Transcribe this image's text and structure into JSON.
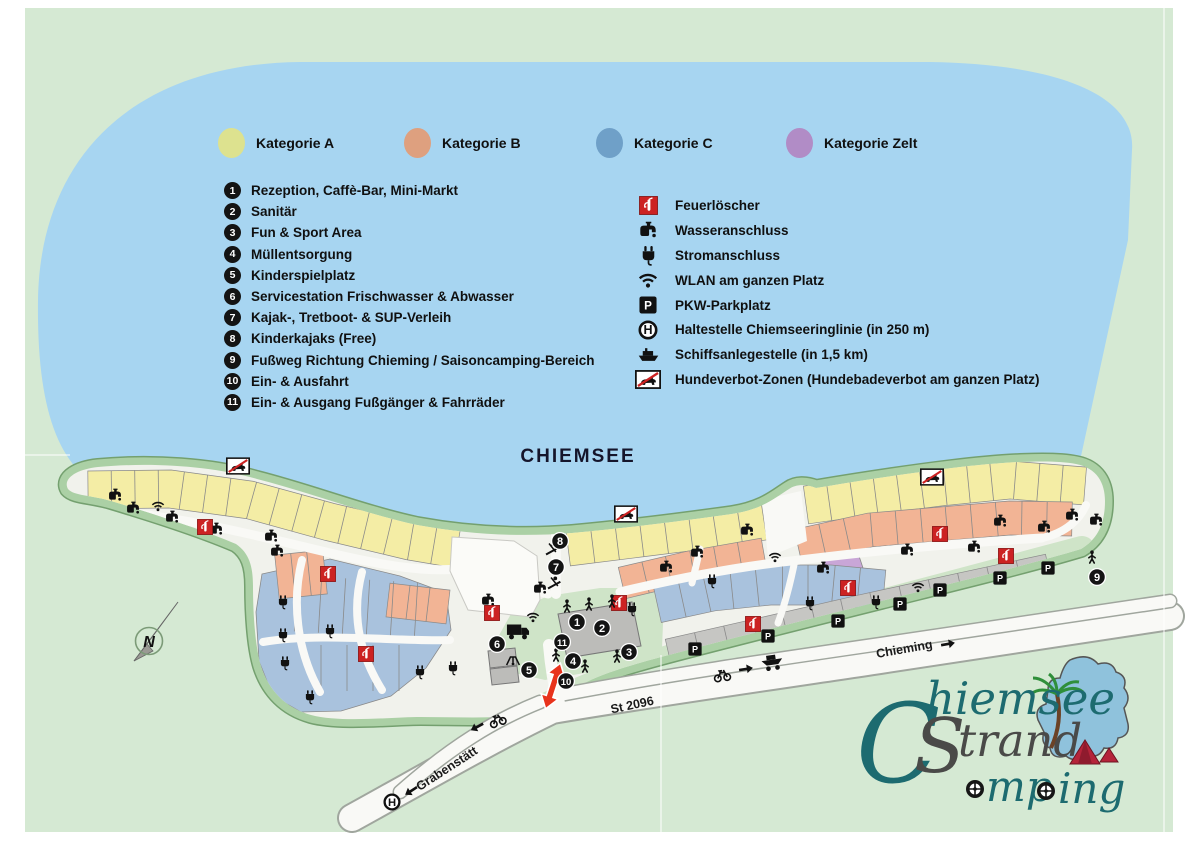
{
  "colors": {
    "background": "#d5e9d3",
    "lake": "#a7d5f1",
    "land_border": "#abd0a5",
    "land_rim": "#74a06f",
    "land_base": "#f1f2ec",
    "lawn": "#cfe4c8",
    "road": "#f9f9f6",
    "road_casing": "#a0a69e",
    "parking": "#c6c6c3",
    "building": "#bcbcb9",
    "kategorie_a": "#dde28f",
    "kategorie_b": "#dea07f",
    "kategorie_c": "#6fa0c8",
    "kategorie_zelt": "#b18cc6",
    "pitch_a": "#f4eda5",
    "pitch_b": "#f2b495",
    "pitch_c": "#a9c2dd",
    "pitch_zelt": "#c9a6d7",
    "fire_red": "#cc2222",
    "arrow_red": "#e8331c"
  },
  "legend": {
    "categories": [
      {
        "label": "Kategorie A",
        "color": "#dde28f"
      },
      {
        "label": "Kategorie B",
        "color": "#dea07f"
      },
      {
        "label": "Kategorie C",
        "color": "#6fa0c8"
      },
      {
        "label": "Kategorie Zelt",
        "color": "#b18cc6"
      }
    ],
    "items": [
      {
        "number": "1",
        "label": "Rezeption, Caffè-Bar, Mini-Markt"
      },
      {
        "number": "2",
        "label": "Sanitär"
      },
      {
        "number": "3",
        "label": "Fun & Sport Area"
      },
      {
        "number": "4",
        "label": "Müllentsorgung"
      },
      {
        "number": "5",
        "label": "Kinderspielplatz"
      },
      {
        "number": "6",
        "label": "Servicestation Frischwasser & Abwasser"
      },
      {
        "number": "7",
        "label": "Kajak-, Tretboot- & SUP-Verleih"
      },
      {
        "number": "8",
        "label": "Kinderkajaks (Free)"
      },
      {
        "number": "9",
        "label": "Fußweg Richtung Chieming / Saisoncamping-Bereich"
      },
      {
        "number": "10",
        "label": "Ein- & Ausfahrt"
      },
      {
        "number": "11",
        "label": "Ein- & Ausgang Fußgänger & Fahrräder"
      }
    ],
    "icon_items": [
      {
        "icon": "fireext",
        "label": "Feuerlöscher"
      },
      {
        "icon": "faucet",
        "label": "Wasseranschluss"
      },
      {
        "icon": "plug",
        "label": "Stromanschluss"
      },
      {
        "icon": "wifi",
        "label": "WLAN am ganzen Platz"
      },
      {
        "icon": "parking",
        "label": "PKW-Parkplatz"
      },
      {
        "icon": "bus-stop",
        "label": "Haltestelle Chiemseeringlinie (in 250 m)"
      },
      {
        "icon": "ship",
        "label": "Schiffsanlegestelle (in 1,5 km)"
      },
      {
        "icon": "no-dog",
        "label": "Hundeverbot-Zonen (Hundebadeverbot am ganzen Platz)"
      }
    ]
  },
  "map": {
    "lake_label": "CHIEMSEE",
    "compass": "N",
    "glyphs": {
      "p": "P",
      "h": "H"
    },
    "roads": {
      "st2096": "St 2096",
      "grabenstaett": "Grabenstätt",
      "chieming": "Chieming"
    },
    "markers": [
      {
        "n": "1",
        "x": 577,
        "y": 622
      },
      {
        "n": "2",
        "x": 602,
        "y": 628
      },
      {
        "n": "3",
        "x": 629,
        "y": 652
      },
      {
        "n": "4",
        "x": 573,
        "y": 661
      },
      {
        "n": "5",
        "x": 529,
        "y": 670
      },
      {
        "n": "6",
        "x": 497,
        "y": 644
      },
      {
        "n": "7",
        "x": 556,
        "y": 567
      },
      {
        "n": "8",
        "x": 560,
        "y": 541
      },
      {
        "n": "9",
        "x": 1097,
        "y": 577
      },
      {
        "n": "10",
        "x": 566,
        "y": 681
      },
      {
        "n": "11",
        "x": 562,
        "y": 642
      }
    ],
    "icons": [
      {
        "t": "faucet",
        "x": 115,
        "y": 495
      },
      {
        "t": "faucet",
        "x": 133,
        "y": 508
      },
      {
        "t": "faucet",
        "x": 172,
        "y": 517
      },
      {
        "t": "faucet",
        "x": 216,
        "y": 529
      },
      {
        "t": "faucet",
        "x": 271,
        "y": 536
      },
      {
        "t": "faucet",
        "x": 277,
        "y": 551
      },
      {
        "t": "faucet",
        "x": 488,
        "y": 600
      },
      {
        "t": "faucet",
        "x": 540,
        "y": 588
      },
      {
        "t": "faucet",
        "x": 666,
        "y": 567
      },
      {
        "t": "faucet",
        "x": 697,
        "y": 552
      },
      {
        "t": "faucet",
        "x": 747,
        "y": 530
      },
      {
        "t": "faucet",
        "x": 823,
        "y": 568
      },
      {
        "t": "faucet",
        "x": 907,
        "y": 550
      },
      {
        "t": "faucet",
        "x": 974,
        "y": 547
      },
      {
        "t": "faucet",
        "x": 1000,
        "y": 521
      },
      {
        "t": "faucet",
        "x": 1044,
        "y": 527
      },
      {
        "t": "faucet",
        "x": 1072,
        "y": 515
      },
      {
        "t": "faucet",
        "x": 1096,
        "y": 520
      },
      {
        "t": "plug",
        "x": 283,
        "y": 602
      },
      {
        "t": "plug",
        "x": 283,
        "y": 635
      },
      {
        "t": "plug",
        "x": 285,
        "y": 663
      },
      {
        "t": "plug",
        "x": 310,
        "y": 697
      },
      {
        "t": "plug",
        "x": 330,
        "y": 631
      },
      {
        "t": "plug",
        "x": 420,
        "y": 672
      },
      {
        "t": "plug",
        "x": 453,
        "y": 668
      },
      {
        "t": "plug",
        "x": 632,
        "y": 609
      },
      {
        "t": "plug",
        "x": 712,
        "y": 581
      },
      {
        "t": "plug",
        "x": 810,
        "y": 603
      },
      {
        "t": "plug",
        "x": 876,
        "y": 602
      },
      {
        "t": "wifi",
        "x": 158,
        "y": 506
      },
      {
        "t": "wifi",
        "x": 533,
        "y": 617
      },
      {
        "t": "wifi",
        "x": 775,
        "y": 557
      },
      {
        "t": "wifi",
        "x": 918,
        "y": 587
      },
      {
        "t": "fireext",
        "x": 205,
        "y": 527
      },
      {
        "t": "fireext",
        "x": 328,
        "y": 574
      },
      {
        "t": "fireext",
        "x": 366,
        "y": 654
      },
      {
        "t": "fireext",
        "x": 492,
        "y": 613
      },
      {
        "t": "fireext",
        "x": 619,
        "y": 603
      },
      {
        "t": "fireext",
        "x": 753,
        "y": 624
      },
      {
        "t": "fireext",
        "x": 848,
        "y": 588
      },
      {
        "t": "fireext",
        "x": 940,
        "y": 534
      },
      {
        "t": "fireext",
        "x": 1006,
        "y": 556
      },
      {
        "t": "parking",
        "x": 695,
        "y": 649
      },
      {
        "t": "parking",
        "x": 768,
        "y": 636
      },
      {
        "t": "parking",
        "x": 838,
        "y": 621
      },
      {
        "t": "parking",
        "x": 900,
        "y": 604
      },
      {
        "t": "parking",
        "x": 940,
        "y": 590
      },
      {
        "t": "parking",
        "x": 1000,
        "y": 578
      },
      {
        "t": "parking",
        "x": 1048,
        "y": 568
      },
      {
        "t": "no-dog",
        "x": 238,
        "y": 466
      },
      {
        "t": "no-dog",
        "x": 626,
        "y": 514
      },
      {
        "t": "no-dog",
        "x": 932,
        "y": 477
      },
      {
        "t": "bus-stop",
        "x": 392,
        "y": 802
      },
      {
        "t": "bike",
        "x": 497,
        "y": 719,
        "r": -20
      },
      {
        "t": "bike",
        "x": 722,
        "y": 674,
        "r": -8
      },
      {
        "t": "arrow-l",
        "x": 477,
        "y": 727,
        "r": -28
      },
      {
        "t": "arrow-r",
        "x": 746,
        "y": 669,
        "r": -9
      },
      {
        "t": "arrow-l",
        "x": 411,
        "y": 791,
        "r": -33
      },
      {
        "t": "arrow-r",
        "x": 948,
        "y": 644,
        "r": -10
      },
      {
        "t": "boat",
        "x": 772,
        "y": 661,
        "r": -8
      },
      {
        "t": "truck",
        "x": 518,
        "y": 631
      },
      {
        "t": "person",
        "x": 567,
        "y": 606
      },
      {
        "t": "person",
        "x": 589,
        "y": 604
      },
      {
        "t": "person",
        "x": 612,
        "y": 601
      },
      {
        "t": "person",
        "x": 556,
        "y": 655
      },
      {
        "t": "person",
        "x": 585,
        "y": 666
      },
      {
        "t": "person",
        "x": 617,
        "y": 656
      },
      {
        "t": "person",
        "x": 1092,
        "y": 557
      },
      {
        "t": "kayak",
        "x": 552,
        "y": 549
      },
      {
        "t": "kayak",
        "x": 554,
        "y": 583
      },
      {
        "t": "playground",
        "x": 513,
        "y": 660
      }
    ]
  },
  "logo": {
    "name": "Chiemsee Strand Camping",
    "part_c": "C",
    "part_hiemsee": "hiemsee",
    "part_s": "S",
    "part_trand": "trand",
    "part_mp": "mp",
    "part_ing": "ing"
  }
}
